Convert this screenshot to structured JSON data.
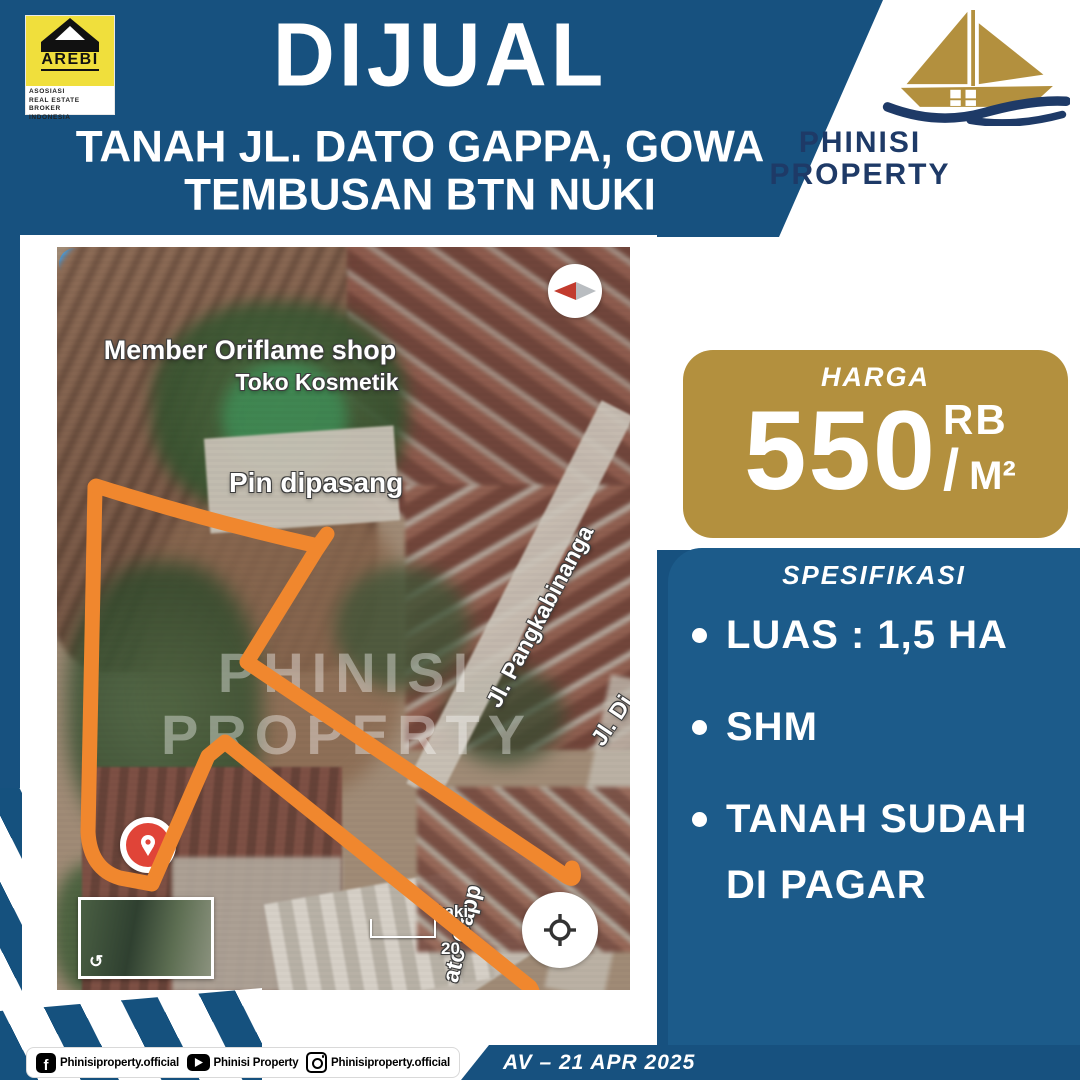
{
  "header": {
    "arebi": {
      "name": "AREBI",
      "sub": [
        "ASOSIASI",
        "REAL ESTATE BROKER",
        "INDONESIA"
      ]
    },
    "title": "DIJUAL",
    "subtitle1": "TANAH JL. DATO GAPPA, GOWA",
    "subtitle2": "TEMBUSAN BTN NUKI",
    "brand1": "PHINISI",
    "brand2": "PROPERTY"
  },
  "map": {
    "poi_title": "Member Oriflame shop",
    "poi_subtitle": "Toko Kosmetik",
    "pin_label": "Pin dipasang",
    "street1": "Jl. Pangkabinanga",
    "street2": "Jl. Di",
    "street3": "ato Gapp",
    "scale_feet": "kaki",
    "scale_meters": "20",
    "watermark1": "PHINISI",
    "watermark2": "PROPERTY"
  },
  "price": {
    "label": "HARGA",
    "amount": "550",
    "unit_top": "RB",
    "slash": "/",
    "unit_bottom": "M²"
  },
  "specs": {
    "title": "SPESIFIKASI",
    "items": [
      "LUAS : 1,5 HA",
      "SHM",
      "TANAH SUDAH DI PAGAR"
    ]
  },
  "footer": {
    "social": [
      {
        "icon": "facebook-icon",
        "handle": "Phinisiproperty.official"
      },
      {
        "icon": "youtube-icon",
        "handle": "Phinisi Property"
      },
      {
        "icon": "instagram-icon",
        "handle": "Phinisiproperty.official"
      }
    ],
    "code_date": "AV – 21 APR 2025"
  },
  "colors": {
    "background": "#17517F",
    "panel": "#1C5B8A",
    "gold": "#B3903E",
    "orange": "#F0872E",
    "navy_brand": "#1E3A67",
    "arebi_yellow": "#F0DF3C",
    "poi_blue": "#37A3F5",
    "pin_teal": "#14A5B4",
    "marker_red": "#E04438"
  }
}
